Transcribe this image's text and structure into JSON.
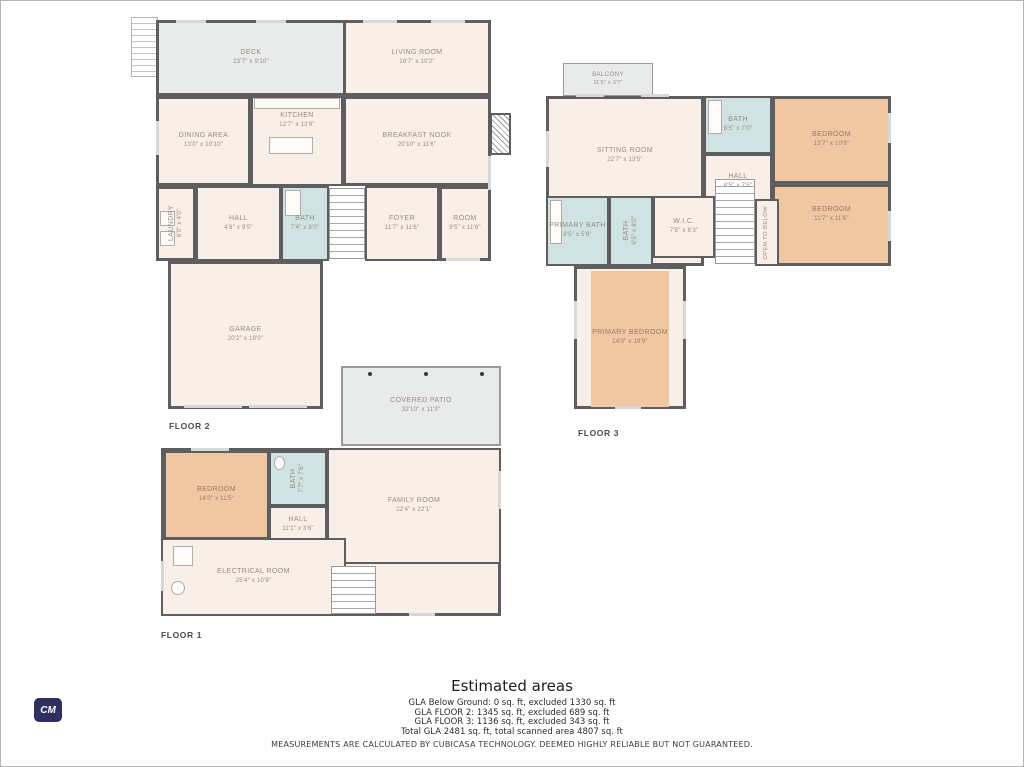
{
  "palette": {
    "wall": "#5e5e60",
    "interior": "#f7efe8",
    "bedroom_fill": "#efc7a2",
    "bath_fill": "#cfe3e3",
    "outdoor_fill": "#e9eaea",
    "label_text": "#968c83",
    "logo_bg": "#2e3061"
  },
  "floors": [
    {
      "label": "FLOOR 2",
      "rooms": {
        "deck": {
          "name": "DECK",
          "dims": "23'7\" x 9'10\""
        },
        "living_room": {
          "name": "LIVING ROOM",
          "dims": "18'7\" x 10'2\""
        },
        "dining_area": {
          "name": "DINING AREA",
          "dims": "13'0\" x 10'10\""
        },
        "kitchen": {
          "name": "KITCHEN",
          "dims": "12'7\" x 13'9\""
        },
        "breakfast_nook": {
          "name": "BREAKFAST NOOK",
          "dims": "20'10\" x 11'6\""
        },
        "laundry": {
          "name": "LAUNDRY",
          "dims": "6'0\" x 4'0\""
        },
        "hall": {
          "name": "HALL",
          "dims": "4'8\" x 9'5\""
        },
        "bath": {
          "name": "BATH",
          "dims": "7'4\" x 8'0\""
        },
        "foyer": {
          "name": "FOYER",
          "dims": "11'7\" x 11'6\""
        },
        "room": {
          "name": "ROOM",
          "dims": "9'5\" x 11'6\""
        },
        "garage": {
          "name": "GARAGE",
          "dims": "20'2\" x 19'0\""
        }
      }
    },
    {
      "label": "FLOOR 3",
      "rooms": {
        "balcony": {
          "name": "BALCONY",
          "dims": "11'6\" x 3'7\""
        },
        "sitting_room": {
          "name": "SITTING ROOM",
          "dims": "22'7\" x 13'5\""
        },
        "bath": {
          "name": "BATH",
          "dims": "8'5\" x 7'0\""
        },
        "hall": {
          "name": "HALL",
          "dims": "8'5\" x 7'5\""
        },
        "bedroom_a": {
          "name": "BEDROOM",
          "dims": "13'7\" x 10'9\""
        },
        "bedroom_b": {
          "name": "BEDROOM",
          "dims": "11'7\" x 11'6\""
        },
        "primary_bath": {
          "name": "PRIMARY BATH",
          "dims": "8'5\" x 5'6\""
        },
        "bath2": {
          "name": "BATH",
          "dims": "6'5\" x 8'0\""
        },
        "wic": {
          "name": "W.I.C.",
          "dims": "7'5\" x 6'3\""
        },
        "open_to_below": {
          "name": "OPEN TO BELOW"
        },
        "primary_bedroom": {
          "name": "PRIMARY BEDROOM",
          "dims": "14'0\" x 19'9\""
        }
      }
    },
    {
      "label": "FLOOR 1",
      "rooms": {
        "covered_patio": {
          "name": "COVERED PATIO",
          "dims": "32'10\" x 11'3\""
        },
        "bedroom": {
          "name": "BEDROOM",
          "dims": "14'0\" x 11'5\""
        },
        "bath": {
          "name": "BATH",
          "dims": "7'7\" x 7'6\""
        },
        "hall": {
          "name": "HALL",
          "dims": "11'1\" x 3'6\""
        },
        "family_room": {
          "name": "FAMILY ROOM",
          "dims": "22'4\" x 22'1\""
        },
        "electrical_room": {
          "name": "ELECTRICAL ROOM",
          "dims": "25'4\" x 10'6\""
        }
      }
    }
  ],
  "estimated_areas": {
    "title": "Estimated areas",
    "lines": [
      "GLA Below Ground: 0 sq. ft, excluded 1330 sq. ft",
      "GLA FLOOR 2: 1345 sq. ft, excluded 689 sq. ft",
      "GLA FLOOR 3: 1136 sq. ft, excluded 343 sq. ft",
      "Total GLA 2481 sq. ft, total scanned area 4807 sq. ft"
    ]
  },
  "disclaimer": "MEASUREMENTS ARE CALCULATED BY CUBICASA TECHNOLOGY. DEEMED HIGHLY RELIABLE BUT NOT GUARANTEED.",
  "logo": {
    "text": "CM"
  }
}
